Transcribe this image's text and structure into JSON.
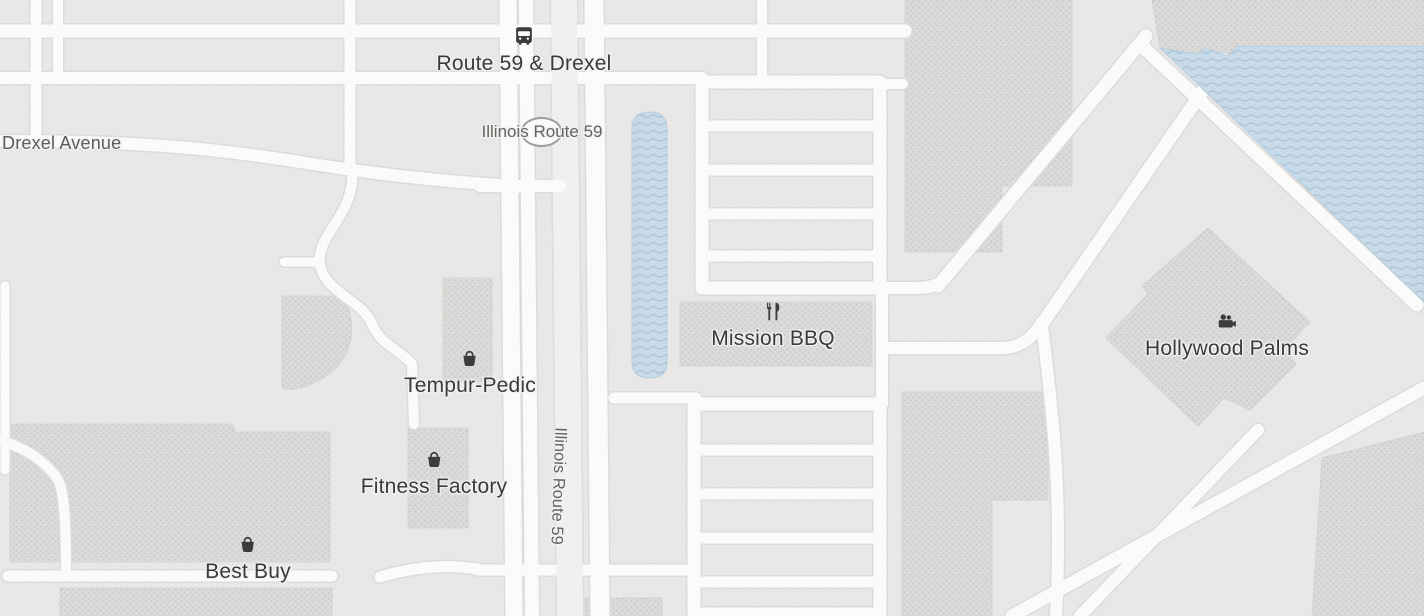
{
  "map": {
    "kind": "street-map",
    "labels": {
      "transit_stop": "Route 59 & Drexel",
      "route_shield": "Illinois Route 59",
      "street_left": "Drexel Avenue",
      "route_vertical": "Illinois Route 59"
    },
    "pois": [
      {
        "name": "Tempur-Pedic",
        "icon": "shopping-bag-icon"
      },
      {
        "name": "Mission BBQ",
        "icon": "restaurant-icon"
      },
      {
        "name": "Fitness Factory",
        "icon": "shopping-bag-icon"
      },
      {
        "name": "Best Buy",
        "icon": "shopping-bag-icon"
      },
      {
        "name": "Hollywood Palms",
        "icon": "movie-camera-icon"
      }
    ],
    "colors": {
      "background": "#e9e8e6",
      "road_fill": "#fbfbfa",
      "road_casing": "#dddcda",
      "median_band": "#f1f0ee",
      "water": "#c8dbe8",
      "water_wave": "#a7c3d7",
      "building": "#dcdbd9",
      "building_dot": "#c8c7c4",
      "poi_text": "#3a3a3c",
      "street_text": "#5e5e5c"
    }
  }
}
